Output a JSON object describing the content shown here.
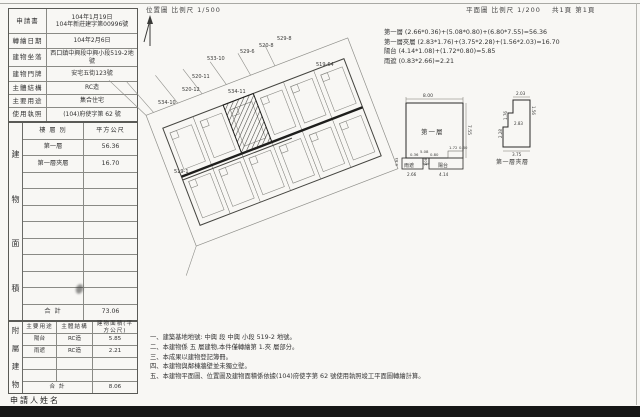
{
  "header": {
    "location_scale": "位置圖 比例尺 1/500",
    "plan_scale": "平面圖 比例尺 1/200",
    "page_info": "共1頁 第1頁"
  },
  "info_table": {
    "rows": [
      {
        "label": "申請書",
        "value": "104年1月19日",
        "value2": "104年新莊建字第00996號"
      },
      {
        "label": "轉繪日期",
        "value": "104年2月6日"
      },
      {
        "label": "建物坐落",
        "value": "西口鎮中興段中興小段519-2地號"
      },
      {
        "label": "建物門牌",
        "value": "安宅五街123號"
      },
      {
        "label": "主體結構",
        "value": "RC造"
      },
      {
        "label": "主要用途",
        "value": "集合住宅"
      },
      {
        "label": "使用執照",
        "value": "(104)府使字第 62 號"
      }
    ]
  },
  "area_table": {
    "side_chars": [
      "建",
      "物",
      "面",
      "積"
    ],
    "col_floor": "樓 層 別",
    "col_area": "平方公尺",
    "rows": [
      {
        "floor": "第一層",
        "area": "56.36"
      },
      {
        "floor": "第一層夾層",
        "area": "16.70"
      }
    ],
    "total_label": "合  計",
    "total": "73.06"
  },
  "annex_table": {
    "side_chars": [
      "附",
      "屬",
      "建",
      "物"
    ],
    "col_use": "主要用途",
    "col_structure": "主體結構",
    "col_area": "建物面積(平方公尺)",
    "rows": [
      {
        "use": "陽台",
        "structure": "RC造",
        "area": "5.85"
      },
      {
        "use": "雨遮",
        "structure": "RC造",
        "area": "2.21"
      }
    ],
    "total_label": "合  計",
    "total": "8.06"
  },
  "applicant_label": "申請人姓名",
  "formulas": [
    "第一層 (2.66*0.36)+(5.08*0.80)+(6.80*7.55)=56.36",
    "第一層夾層 (2.83*1.76)+(3.75*2.28)+(1.56*2.03)=16.70",
    "陽台 (4.14*1.08)+(1.72*0.80)=5.85",
    "雨遮 (0.83*2.66)=2.21"
  ],
  "notes": [
    "一、建築基地地號: 中興 段 中興 小段 519-2 地號。",
    "二、本建物係 五 層建物,本件僅轉繪第 1.夾 層部分。",
    "三、本成果以建物登記簿冊。",
    "四、本建物與鄰棟牆壁並未獨立壁。",
    "五、本建物平面圖、位置圖及建物面積係依據(104)府使字第 62 號使用執照竣工平面圖轉繪計算。"
  ],
  "site_plan": {
    "lots": [
      {
        "id": "533-10"
      },
      {
        "id": "529-6"
      },
      {
        "id": "520-8"
      },
      {
        "id": "529-8"
      },
      {
        "id": "520-11"
      },
      {
        "id": "520-12"
      },
      {
        "id": "534-10"
      },
      {
        "id": "534-11"
      },
      {
        "id": "519-64"
      },
      {
        "id": "519-1"
      }
    ]
  },
  "floor_plan": {
    "title": "第一層",
    "dim_top": "8.00",
    "dim_right": "7.55",
    "dim_small": "0.36",
    "dim_strip": "5.08",
    "dim_strip_h": "0.80",
    "canopy_label": "雨遮",
    "canopy_w": "2.66",
    "canopy_h": "0.83",
    "balcony_label": "陽台",
    "balcony_w": "4.14",
    "balcony_h": "1.08",
    "corner_w": "1.72",
    "corner_h": "0.80"
  },
  "mezz_plan": {
    "title": "第一層夾層",
    "dim_top": "2.03",
    "dim_right": "1.56",
    "dim_mid_left": "1.76",
    "dim_mid": "2.83",
    "dim_low_left": "2.28",
    "dim_bottom": "3.75"
  },
  "colors": {
    "paper": "#f8f7f4",
    "line": "#555555",
    "ink": "#222222",
    "bar": "#161616"
  }
}
